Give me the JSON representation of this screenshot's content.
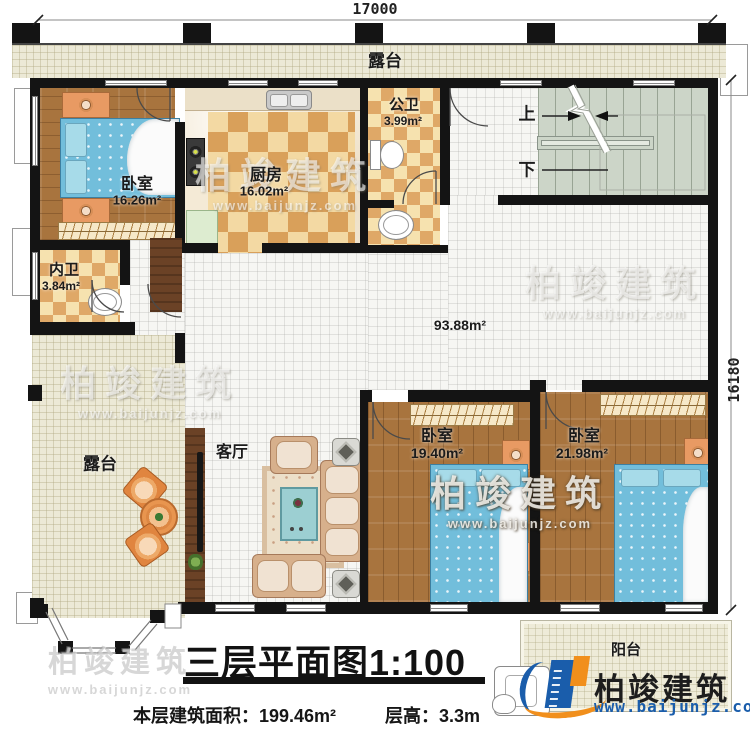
{
  "dimensions": {
    "top": "17000",
    "right": "16180"
  },
  "rooms": {
    "terrace_top": {
      "name": "露台"
    },
    "bedroom_tl": {
      "name": "卧室",
      "area": "16.26m²"
    },
    "kitchen": {
      "name": "厨房",
      "area": "16.02m²"
    },
    "public_bath": {
      "name": "公卫",
      "area": "3.99m²"
    },
    "inner_bath": {
      "name": "内卫",
      "area": "3.84m²"
    },
    "hall": {
      "area": "93.88m²"
    },
    "living": {
      "name": "客厅"
    },
    "terrace_left": {
      "name": "露台"
    },
    "bedroom_left": {
      "name": "卧室",
      "area": "19.40m²"
    },
    "bedroom_right": {
      "name": "卧室",
      "area": "21.98m²"
    },
    "balcony": {
      "name": "阳台"
    }
  },
  "stairs": {
    "up": "上",
    "down": "下"
  },
  "title": {
    "text": "三层平面图1:100"
  },
  "footer": {
    "area": "本层建筑面积：199.46m²",
    "height": "层高：3.3m"
  },
  "brand": {
    "name": "柏竣建筑",
    "url": "www.baijunjz.com"
  },
  "watermark": {
    "name": "柏竣建筑",
    "url": "www.baijunjz.com"
  },
  "colors": {
    "wall": "#141414",
    "wood_floor": "#a8743e",
    "terrace_floor": "#ece9d6",
    "checker_tile": "#d9a05a",
    "stair_floor": "#ccd5c8",
    "brand_blue": "#1a5dab",
    "brand_orange": "#f18f1c"
  }
}
